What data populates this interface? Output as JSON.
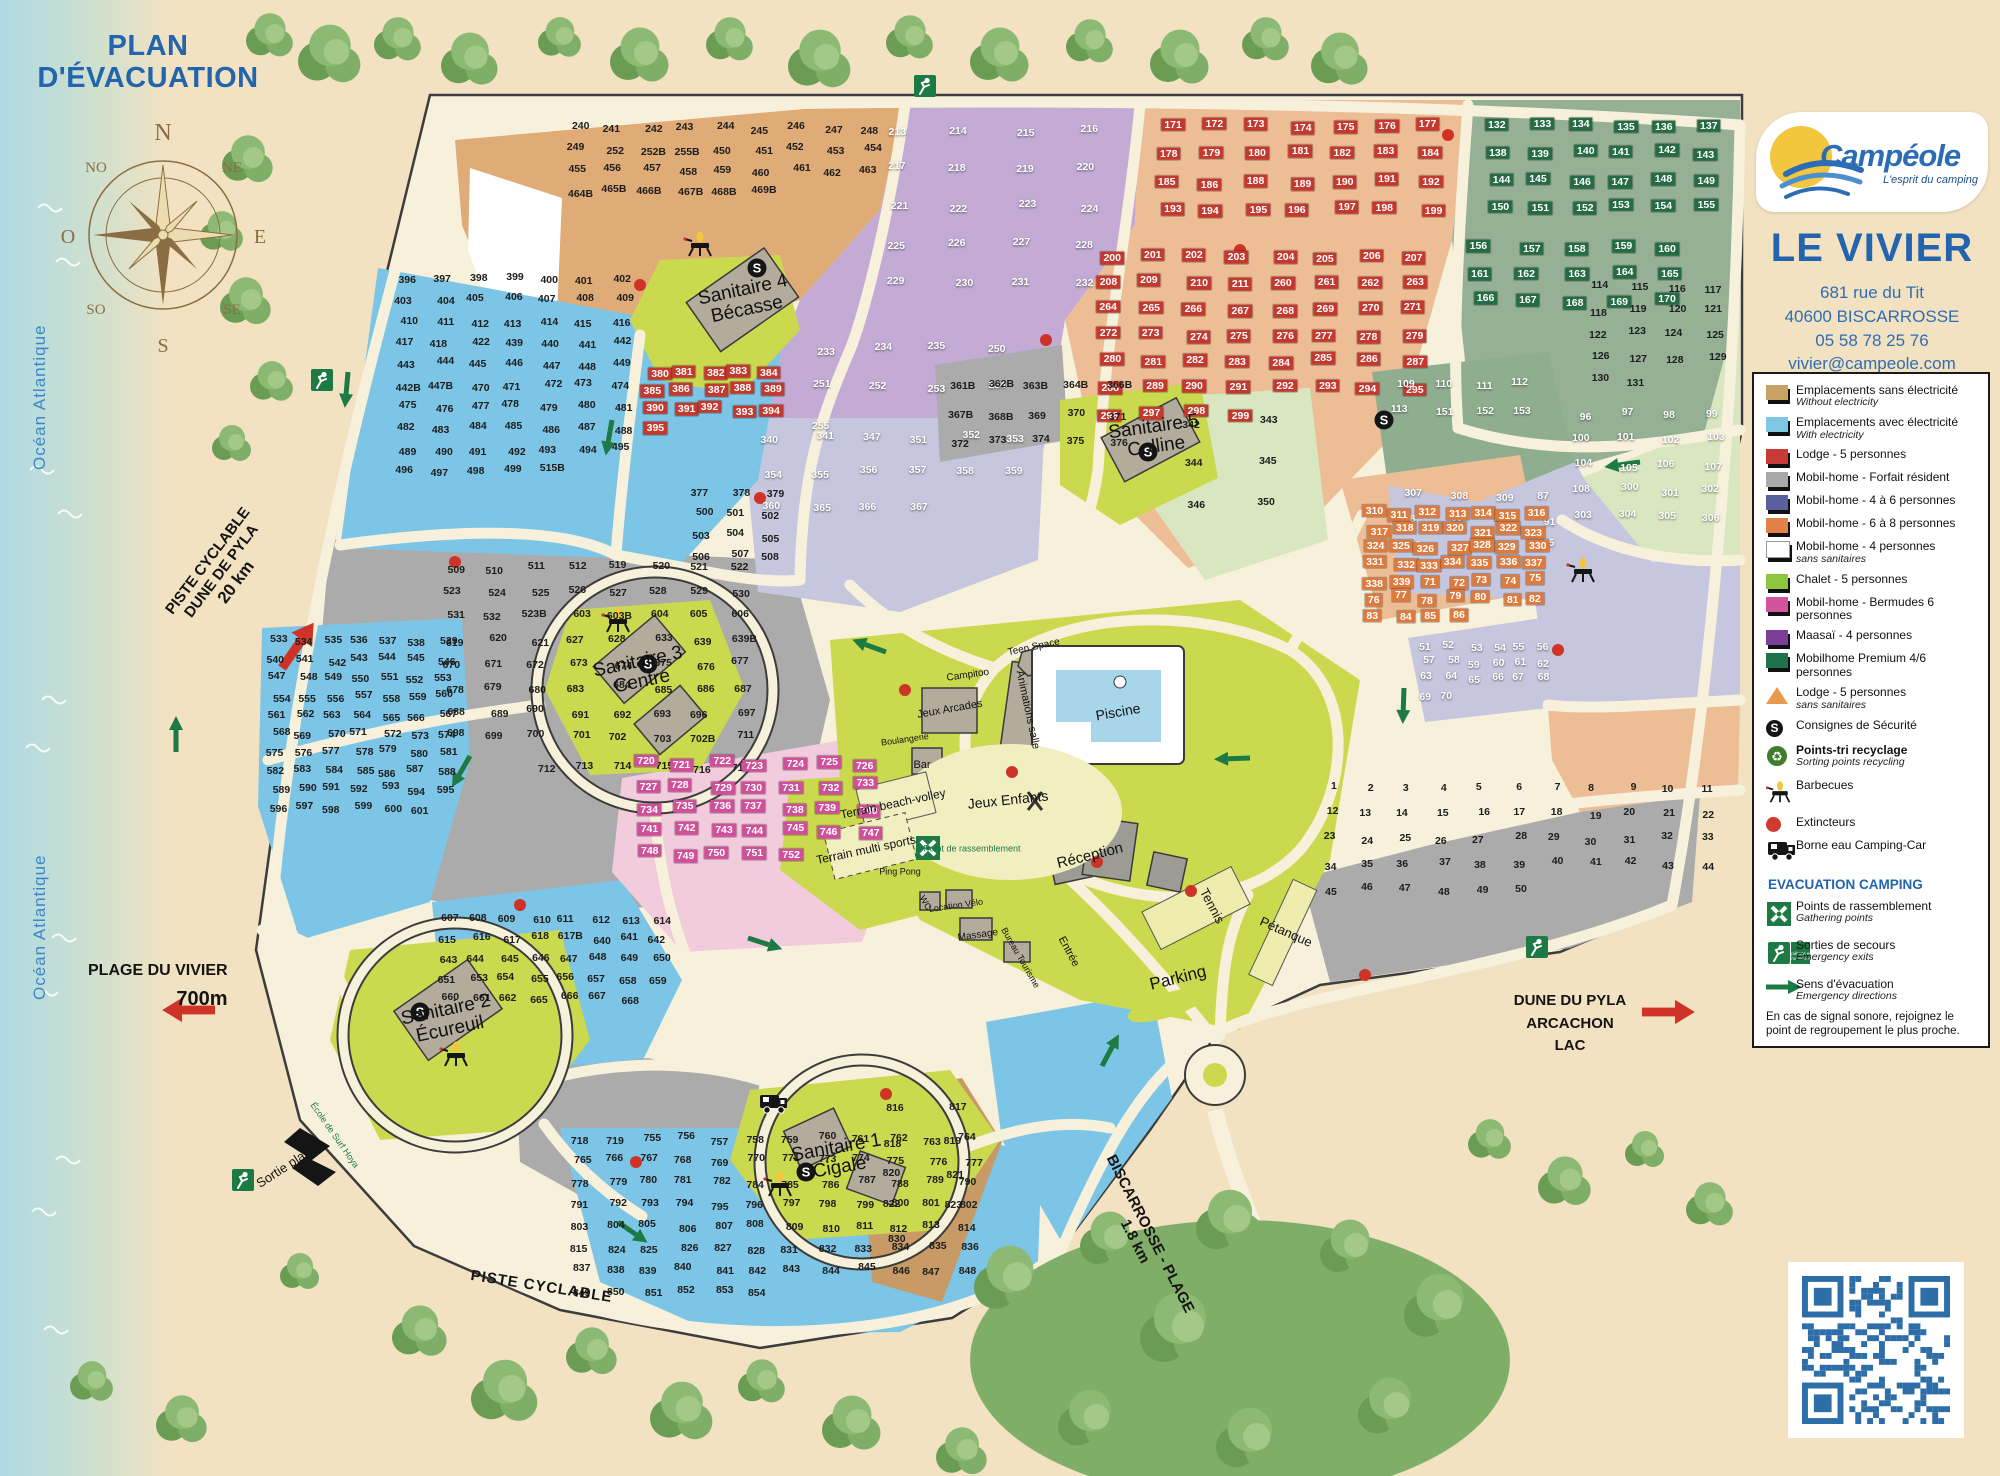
{
  "header": {
    "title_line1": "PLAN",
    "title_line2": "D'ÉVACUATION"
  },
  "ocean_label": "Océan Atlantique",
  "compass": {
    "n": "N",
    "ne": "NE",
    "e": "E",
    "se": "SE",
    "s": "S",
    "so": "SO",
    "o": "O",
    "no": "NO"
  },
  "brand": {
    "logo_text": "Campéole",
    "tagline": "L'esprit du camping",
    "site_name": "LE VIVIER",
    "address_line1": "681 rue du Tit",
    "address_line2": "40600 BISCARROSSE",
    "phone": "05 58 78 25 76",
    "email": "vivier@campeole.com"
  },
  "legend": {
    "items": [
      {
        "type": "swatch",
        "color": "#c8a165",
        "label": "Emplacements sans électricité",
        "sub": "Without electricity"
      },
      {
        "type": "swatch",
        "color": "#7ec8e3",
        "label": "Emplacements avec électricité",
        "sub": "With electricity"
      },
      {
        "type": "swatch",
        "color": "#c73a35",
        "label": "Lodge - 5 personnes"
      },
      {
        "type": "swatch",
        "color": "#a9a9a9",
        "label": "Mobil-home - Forfait résident"
      },
      {
        "type": "swatch",
        "color": "#5a5f9e",
        "label": "Mobil-home - 4 à 6 personnes"
      },
      {
        "type": "swatch",
        "color": "#e2824a",
        "label": "Mobil-home - 6 à 8 personnes"
      },
      {
        "type": "swatch",
        "color": "#ffffff",
        "label": "Mobil-home - 4 personnes",
        "sub": "sans sanitaires"
      },
      {
        "type": "swatch",
        "color": "#8bc63e",
        "label": "Chalet - 5 personnes"
      },
      {
        "type": "swatch",
        "color": "#d1549c",
        "label": "Mobil-home - Bermudes 6 personnes"
      },
      {
        "type": "swatch",
        "color": "#7c3f97",
        "label": "Maasaï - 4 personnes"
      },
      {
        "type": "swatch",
        "color": "#20724a",
        "label": "Mobilhome Premium 4/6 personnes"
      },
      {
        "type": "triangle",
        "label": "Lodge - 5 personnes",
        "sub": "sans sanitaires"
      },
      {
        "type": "s-icon",
        "label": "Consignes de Sécurité"
      },
      {
        "type": "recycle-icon",
        "label": "Points-tri recyclage",
        "sub": "Sorting points recycling",
        "bold": true
      },
      {
        "type": "bbq-icon",
        "label": "Barbecues"
      },
      {
        "type": "dot",
        "label": "Extincteurs"
      },
      {
        "type": "truck-icon",
        "label": "Borne eau Camping-Car"
      }
    ],
    "evacuation_heading": "EVACUATION CAMPING",
    "evacuation_items": [
      {
        "type": "gather-icon",
        "label": "Points de rassemblement",
        "sub": "Gathering points"
      },
      {
        "type": "exit-icon",
        "label": "Sorties de secours",
        "sub": "Emergency exits"
      },
      {
        "type": "arrow-icon",
        "label": "Sens d'évacuation",
        "sub": "Emergency directions"
      }
    ],
    "note": "En cas de signal sonore, rejoignez le point de regroupement le plus proche."
  },
  "outer_labels": {
    "piste_line1": "PISTE CYCLABLE",
    "piste_line2": "DUNE DE PYLA",
    "piste_line3": "20 km",
    "plage_vivier": "PLAGE DU VIVIER",
    "plage_vivier_dist": "700m",
    "sortie_plage": "Sortie plage",
    "ecole_surf": "École de Surf Hoya",
    "piste_bottom": "PISTE CYCLABLE",
    "biscarrosse_line1": "BISCARROSSE - PLAGE",
    "biscarrosse_line2": "1.8 km",
    "dune_line1": "DUNE DU PYLA",
    "dune_line2": "ARCACHON",
    "dune_line3": "LAC"
  },
  "facilities": [
    {
      "id": "sanitaire4",
      "label": "Sanitaire 4",
      "sub": "Bécasse"
    },
    {
      "id": "sanitaire5",
      "label": "Sanitaire 5",
      "sub": "Colline"
    },
    {
      "id": "sanitaire3",
      "label": "Sanitaire 3",
      "sub": "Centre"
    },
    {
      "id": "sanitaire2",
      "label": "Sanitaire 2",
      "sub": "Écureuil"
    },
    {
      "id": "sanitaire1",
      "label": "Sanitaire 1",
      "sub": "Cigale"
    },
    {
      "id": "piscine",
      "label": "Piscine"
    },
    {
      "id": "teen-space",
      "label": "Teen Space"
    },
    {
      "id": "campitoo",
      "label": "Campitoo"
    },
    {
      "id": "jeux-arcades",
      "label": "Jeux Arcades"
    },
    {
      "id": "boulangerie",
      "label": "Boulangerie"
    },
    {
      "id": "bar",
      "label": "Bar"
    },
    {
      "id": "animations",
      "label": "Animations salle"
    },
    {
      "id": "jeux-enfants",
      "label": "Jeux Enfants"
    },
    {
      "id": "beach-volley",
      "label": "Terrain beach-volley"
    },
    {
      "id": "multi-sports",
      "label": "Terrain multi sports"
    },
    {
      "id": "ping-pong",
      "label": "Ping Pong"
    },
    {
      "id": "rassemblement",
      "label": "Point de rassemblement"
    },
    {
      "id": "reception",
      "label": "Réception"
    },
    {
      "id": "wc",
      "label": "WC"
    },
    {
      "id": "location-velo",
      "label": "Location Vélo"
    },
    {
      "id": "massage",
      "label": "Massage"
    },
    {
      "id": "bureau",
      "label": "Bureau Tourisme"
    },
    {
      "id": "entree",
      "label": "Entrée"
    },
    {
      "id": "tennis",
      "label": "Tennis"
    },
    {
      "id": "petanque",
      "label": "Pétanque"
    },
    {
      "id": "parking",
      "label": "Parking"
    }
  ],
  "zones": [
    {
      "id": "tan-nw",
      "text": "#1d1d1d",
      "plots": [
        "240-249",
        "252",
        "252B",
        "255B",
        "450-463",
        "464B",
        "465B",
        "466B",
        "467B",
        "468B",
        "469B"
      ]
    },
    {
      "id": "maasai",
      "text": "#ffffff",
      "plots": [
        "213-235",
        "250-255"
      ]
    },
    {
      "id": "lodge-ne",
      "text": "#ffffff",
      "box": "#c4392f",
      "plots": [
        "171-186",
        "188-211",
        "260-299"
      ]
    },
    {
      "id": "premium",
      "text": "#ffffff",
      "box": "#256b43",
      "plots": [
        "132-170"
      ]
    },
    {
      "id": "chalet-ne",
      "text": "#1d1d1d",
      "plots": [
        "114-131"
      ]
    },
    {
      "id": "lavender-e",
      "text": "#ffffff",
      "plots": [
        "96-108",
        "300-309",
        "87-95"
      ]
    },
    {
      "id": "sage-mid",
      "text": "#ffffff",
      "plots": [
        "109-113",
        "151-153"
      ]
    },
    {
      "id": "salmon-mid",
      "text": "#ffffff",
      "box": "#dd7b3e",
      "plots": [
        "310-339",
        "71-86"
      ]
    },
    {
      "id": "lavender-se",
      "text": "#ffffff",
      "plots": [
        "51-70"
      ]
    },
    {
      "id": "gray-se",
      "text": "#1d1d1d",
      "plots": [
        "1-50"
      ]
    },
    {
      "id": "gray-center",
      "text": "#1d1d1d",
      "plots": [
        "361B",
        "362B",
        "363B",
        "364B",
        "366B",
        "367B",
        "368B",
        "369-379",
        "500-512",
        "519-532",
        "523B",
        "603",
        "603B",
        "604-606",
        "619-621",
        "627",
        "628",
        "633",
        "639",
        "639B",
        "670-680",
        "683-693",
        "696-703",
        "702B",
        "711-717"
      ]
    },
    {
      "id": "lavender-center",
      "text": "#ffffff",
      "plots": [
        "340",
        "341",
        "347",
        "351-360",
        "365-367"
      ]
    },
    {
      "id": "chalet-center",
      "text": "#1d1d1d",
      "plots": [
        "342-346",
        "350"
      ]
    },
    {
      "id": "lodge-cluster",
      "text": "#ffffff",
      "box": "#c4392f",
      "plots": [
        "380-395"
      ]
    },
    {
      "id": "blue-nw",
      "text": "#1d1d1d",
      "plots": [
        "396-418",
        "422",
        "439-449",
        "442B",
        "447B",
        "470-499",
        "515B"
      ]
    },
    {
      "id": "blue-w",
      "text": "#1d1d1d",
      "plots": [
        "533-547",
        "548-601"
      ]
    },
    {
      "id": "blue-mid",
      "text": "#1d1d1d",
      "plots": [
        "607-618",
        "617B",
        "640-651",
        "653-662",
        "665-668"
      ]
    },
    {
      "id": "blue-s",
      "text": "#1d1d1d",
      "plots": [
        "718",
        "719",
        "755-771",
        "773-782",
        "784-815",
        "824-828",
        "831-854"
      ]
    },
    {
      "id": "pink",
      "text": "#ffffff",
      "box": "#cf4f98",
      "plots": [
        "720-752"
      ]
    },
    {
      "id": "tan-s",
      "text": "#1d1d1d",
      "plots": [
        "816-823",
        "830"
      ]
    }
  ]
}
